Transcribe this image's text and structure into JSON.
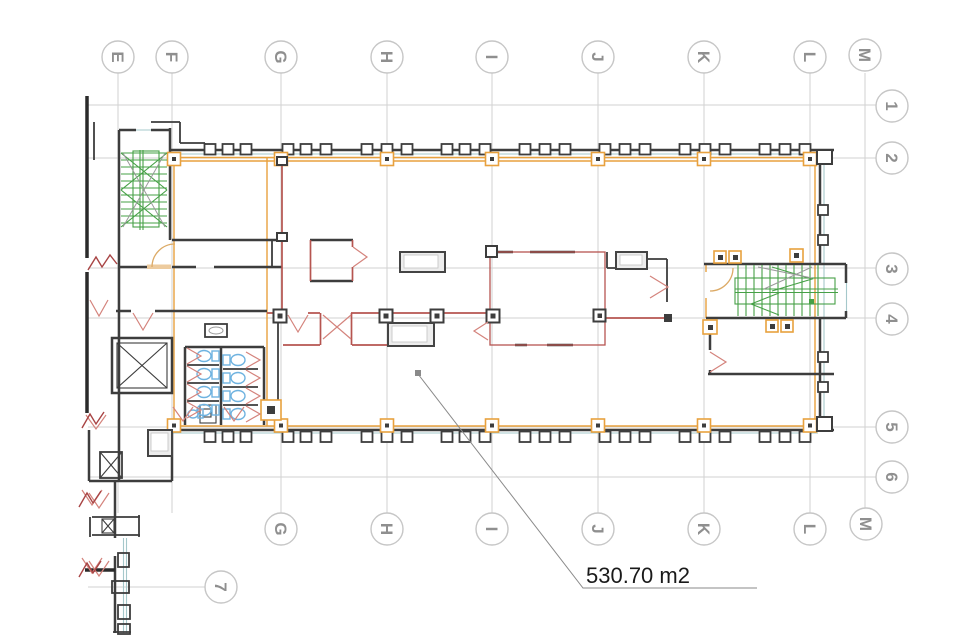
{
  "drawing": {
    "area_label": "530.70 m2"
  },
  "grid": {
    "top_letters": [
      "E",
      "F",
      "G",
      "H",
      "I",
      "J",
      "K",
      "L",
      "M"
    ],
    "bottom_letters": [
      "G",
      "H",
      "I",
      "J",
      "K",
      "L",
      "M"
    ],
    "right_numbers": [
      "1",
      "2",
      "3",
      "4",
      "5",
      "6"
    ],
    "bottom_left_number": "7"
  },
  "colors": {
    "wall": "#3d3d3d",
    "partition_red": "#b65550",
    "door_red": "#d4837c",
    "break_red": "#a84444",
    "accent_orange": "#e8a13e",
    "stair_green": "#46a046",
    "fixture_blue": "#6fb3e0",
    "glazing_teal": "#a5c8cb",
    "grid_line": "#d2d2d2",
    "bubble_text": "#8f8f8f",
    "area_text": "#1a1a1a",
    "leader_gray": "#8a8a8a"
  }
}
